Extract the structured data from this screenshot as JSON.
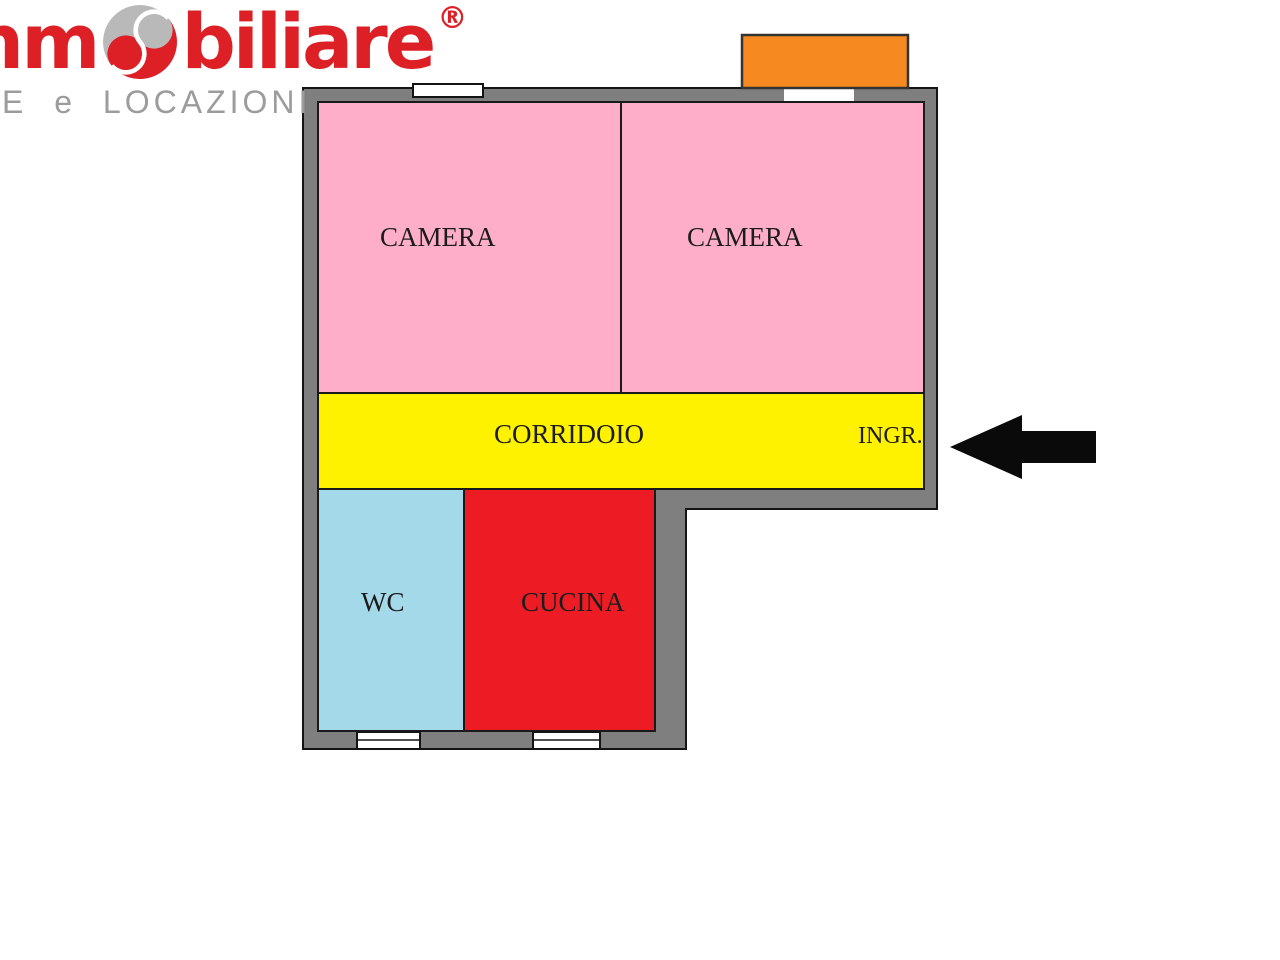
{
  "header": {
    "logo_prefix": "imm",
    "logo_suffix": "biliare",
    "registered_mark": "®",
    "tagline": "E e LOCAZIONI",
    "logo_color": "#DD1F26",
    "tagline_color": "#9C9C9C"
  },
  "floorplan": {
    "wall_color": "#7F7F7F",
    "outline_color": "#141414",
    "rooms": [
      {
        "name": "camera-left",
        "label": "CAMERA",
        "color": "#FFAEC9"
      },
      {
        "name": "camera-right",
        "label": "CAMERA",
        "color": "#FFAEC9"
      },
      {
        "name": "corridoio",
        "label": "CORRIDOIO",
        "color": "#FFF200"
      },
      {
        "name": "ingresso",
        "label": "INGR.",
        "color": "#FFF200"
      },
      {
        "name": "wc",
        "label": "WC",
        "color": "#A4D9EA"
      },
      {
        "name": "cucina",
        "label": "CUCINA",
        "color": "#ED1C24"
      }
    ],
    "balcony": {
      "color": "#F6891F"
    },
    "entrance_arrow": {
      "direction": "left",
      "color": "#0a0a0a"
    }
  }
}
